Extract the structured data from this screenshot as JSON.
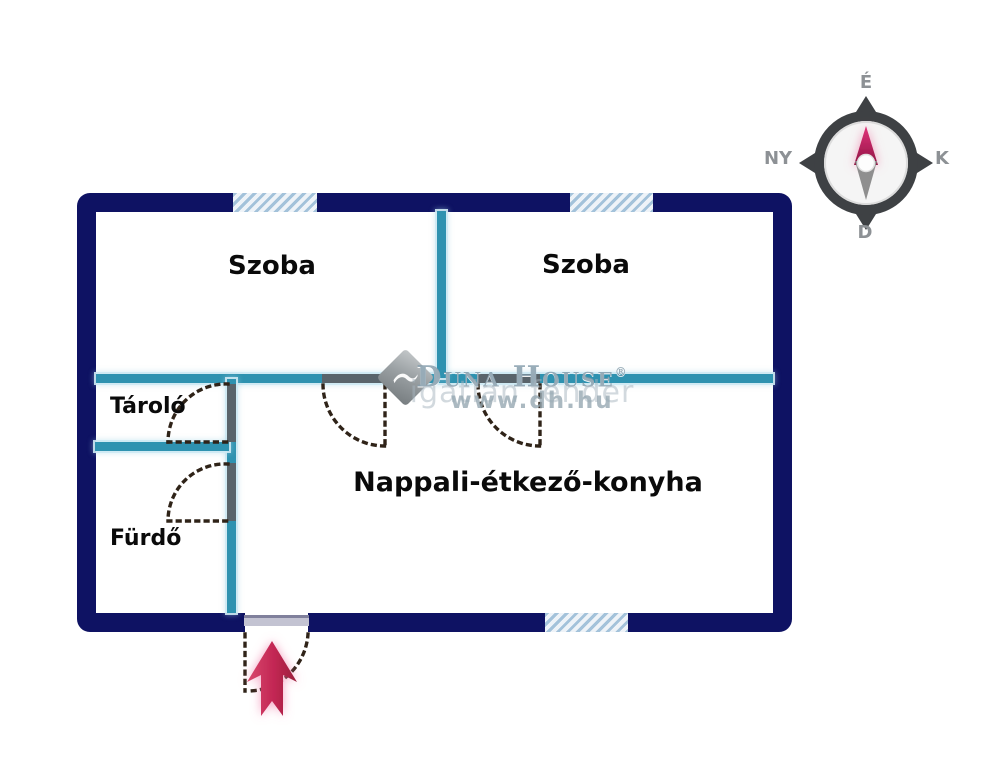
{
  "rooms": [
    {
      "id": "szoba-left",
      "label": "Szoba"
    },
    {
      "id": "szoba-right",
      "label": "Szoba"
    },
    {
      "id": "tarolo",
      "label": "Tároló"
    },
    {
      "id": "furdo",
      "label": "Fürdő"
    },
    {
      "id": "nappali",
      "label": "Nappali-étkező-konyha"
    }
  ],
  "compass": {
    "north": "É",
    "east": "K",
    "south": "D",
    "west": "NY"
  },
  "watermark": {
    "brand": "Duna House",
    "reg": "®",
    "subtext": "igatlan fender",
    "url": "www.dh.hu"
  },
  "colors": {
    "wall-navy": "#0e1263",
    "wall-teal": "#2e92b0",
    "wall-gray": "#59646b",
    "door-dash": "#2f2318",
    "arrow-red": "#c22653",
    "stripe-blue": "#a3c2da",
    "compass-dark": "#3e4144",
    "compass-magenta": "#c21e5c"
  }
}
